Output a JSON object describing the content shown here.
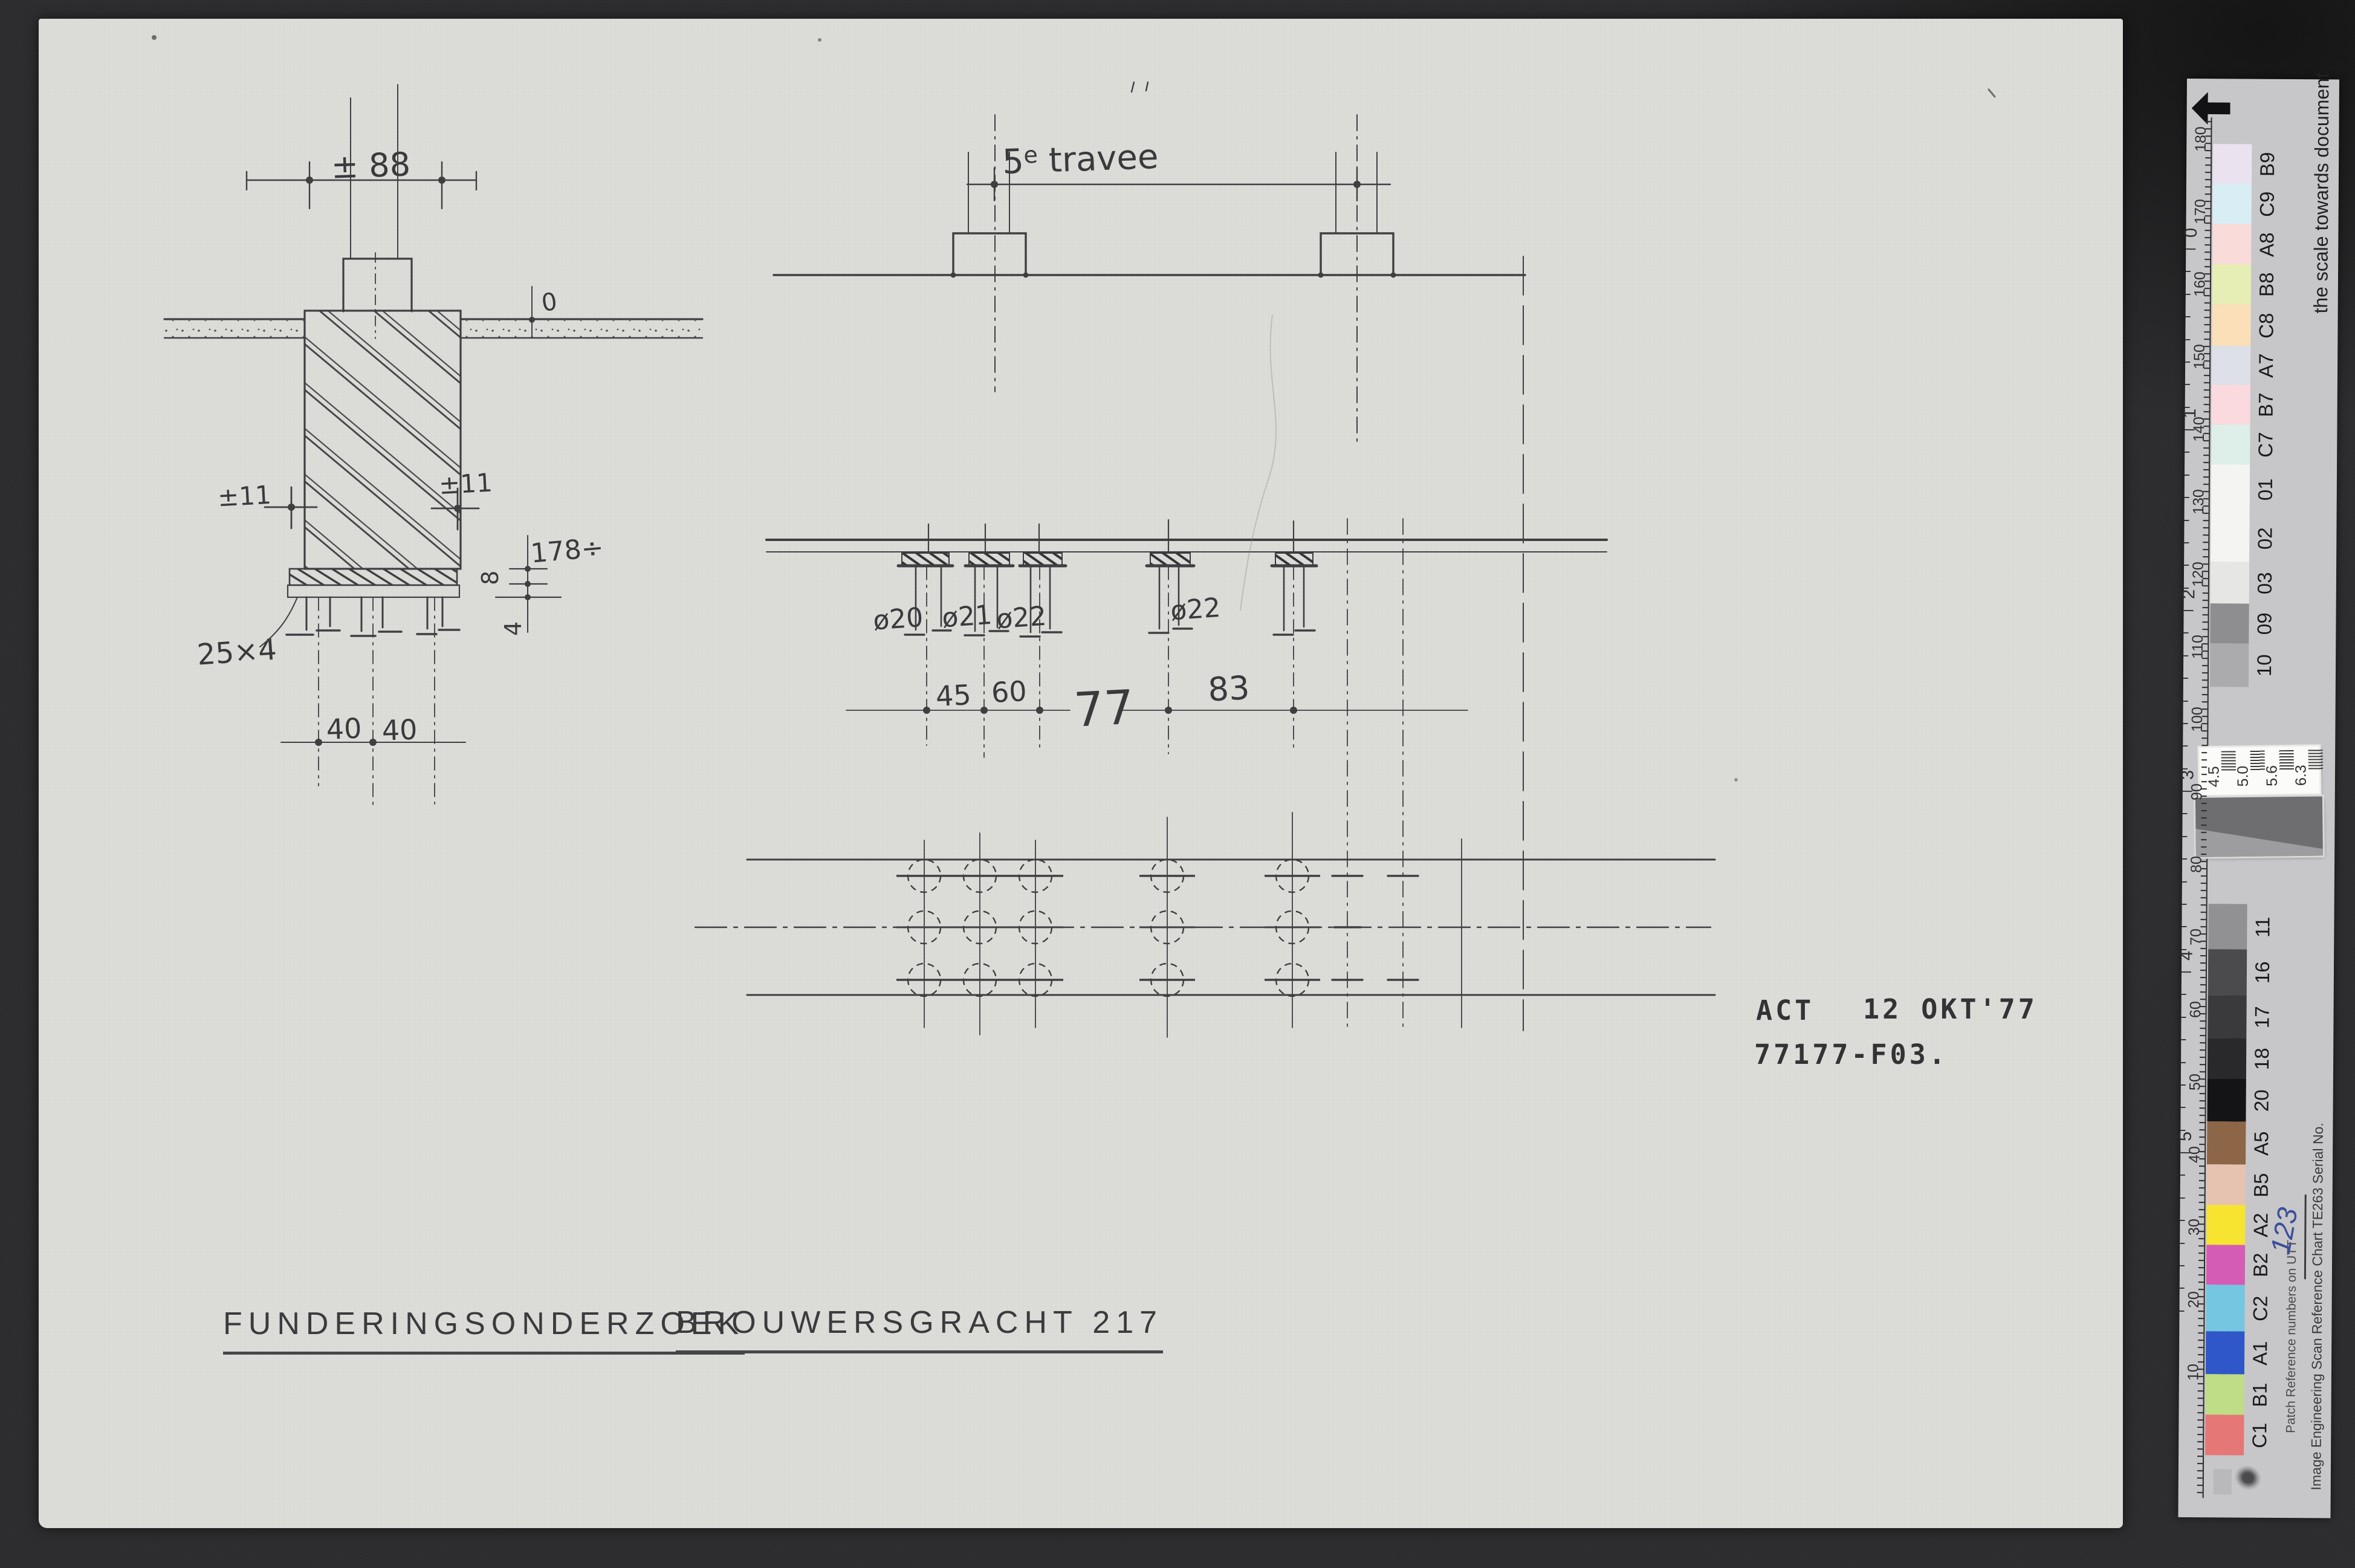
{
  "document": {
    "titles": {
      "left": "FUNDERINGSONDERZOEK",
      "right": "BROUWERSGRACHT 217"
    },
    "stamp": {
      "agency": "ACT",
      "date": "12 OKT'77",
      "drawing_number": "77177-F03."
    },
    "wall_section": {
      "width_top": "± 88",
      "level_zero": "0",
      "offset_left": "±11",
      "offset_right": "±11",
      "depth": "178÷",
      "plank_thickness": "8",
      "pile_head": "4",
      "plank_size": "25×4",
      "pile_spacing": [
        "40",
        "40"
      ]
    },
    "elevation": {
      "bay_label_num": "5",
      "bay_label_sup": "e",
      "bay_label_rest": " travee",
      "pile_diameters": [
        "ø20",
        "ø21",
        "ø22",
        "ø22"
      ],
      "dims": [
        "45",
        "60",
        "77",
        "83"
      ]
    }
  },
  "color_bar": {
    "direction_text": "the scale towards document",
    "mm_label": "mm",
    "ruler_mm": [
      "180",
      "170",
      "160",
      "150",
      "140",
      "130",
      "120",
      "110",
      "100",
      "90",
      "80",
      "70",
      "60",
      "50",
      "40",
      "30",
      "20",
      "10"
    ],
    "ruler_inch": [
      "0",
      "1",
      "2",
      "3",
      "4",
      "5"
    ],
    "patches_upper": [
      {
        "id": "B9",
        "color": "#eae3ef"
      },
      {
        "id": "C9",
        "color": "#d9eef4"
      },
      {
        "id": "A8",
        "color": "#f9dbd9"
      },
      {
        "id": "B8",
        "color": "#e7eeb5"
      },
      {
        "id": "C8",
        "color": "#fadfb8"
      },
      {
        "id": "A7",
        "color": "#dddfe9"
      },
      {
        "id": "B7",
        "color": "#fadadf"
      },
      {
        "id": "C7",
        "color": "#ddefe8"
      },
      {
        "id": "01",
        "color": "#f4f5f3"
      },
      {
        "id": "02",
        "color": "#f4f5f3"
      },
      {
        "id": "03",
        "color": "#e6e7e5"
      },
      {
        "id": "09",
        "color": "#8e8e90"
      },
      {
        "id": "10",
        "color": "#ababad"
      }
    ],
    "patches_lower": [
      {
        "id": "11",
        "color": "#919193"
      },
      {
        "id": "16",
        "color": "#4b4b4d"
      },
      {
        "id": "17",
        "color": "#3a3a3c"
      },
      {
        "id": "18",
        "color": "#29292b"
      },
      {
        "id": "20",
        "color": "#141416"
      },
      {
        "id": "A5",
        "color": "#8d6547"
      },
      {
        "id": "B5",
        "color": "#e6c3b0"
      },
      {
        "id": "A2",
        "color": "#f6e430"
      },
      {
        "id": "B2",
        "color": "#d55cb5"
      },
      {
        "id": "C2",
        "color": "#74c6e1"
      },
      {
        "id": "A1",
        "color": "#2f57c9"
      },
      {
        "id": "B1",
        "color": "#bfdc86"
      },
      {
        "id": "C1",
        "color": "#e57776"
      }
    ],
    "resolution_values": [
      "4.5",
      "5.0",
      "5.6",
      "6.3"
    ],
    "imprint": {
      "maker": "Image Engineering",
      "chart_name": "Scan Reference Chart",
      "chart_code": "TE263",
      "serial_label": "Serial No.",
      "serial_value": "123",
      "patch_note": "Patch Reference numbers on UTT"
    }
  }
}
